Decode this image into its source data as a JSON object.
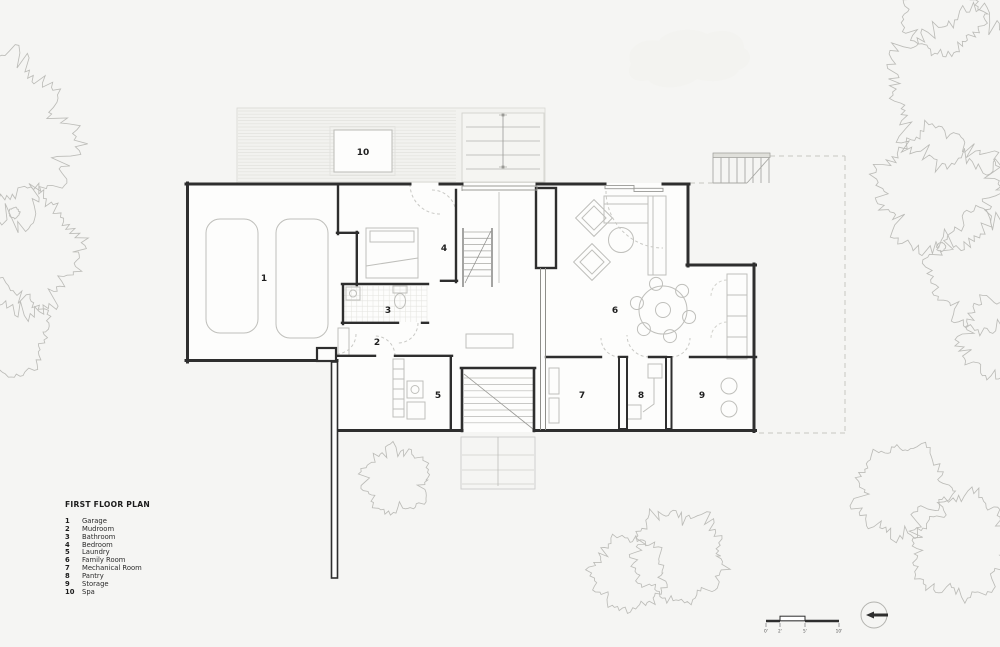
{
  "page": {
    "title": "FIRST FLOOR PLAN"
  },
  "legend": {
    "title": "FIRST FLOOR PLAN",
    "items": [
      {
        "num": "1",
        "label": "Garage"
      },
      {
        "num": "2",
        "label": "Mudroom"
      },
      {
        "num": "3",
        "label": "Bathroom"
      },
      {
        "num": "4",
        "label": "Bedroom"
      },
      {
        "num": "5",
        "label": "Laundry"
      },
      {
        "num": "6",
        "label": "Family Room"
      },
      {
        "num": "7",
        "label": "Mechanical Room"
      },
      {
        "num": "8",
        "label": "Pantry"
      },
      {
        "num": "9",
        "label": "Storage"
      },
      {
        "num": "10",
        "label": "Spa"
      }
    ]
  },
  "plan_labels": {
    "garage": "1",
    "mudroom": "2",
    "bathroom": "3",
    "bedroom": "4",
    "laundry": "5",
    "family_room": "6",
    "mechanical_room": "7",
    "pantry": "8",
    "storage": "9",
    "spa": "10"
  },
  "scale_bar": {
    "labels": [
      "0'",
      "2'",
      "5'",
      "10'"
    ]
  },
  "colors": {
    "background": "#f5f5f3",
    "wall": "#2e2e2e",
    "light_line": "#bfbfbb",
    "dashed": "#c6c6c2",
    "deck_line": "#e2e2dd",
    "text": "#1c1c1c"
  }
}
